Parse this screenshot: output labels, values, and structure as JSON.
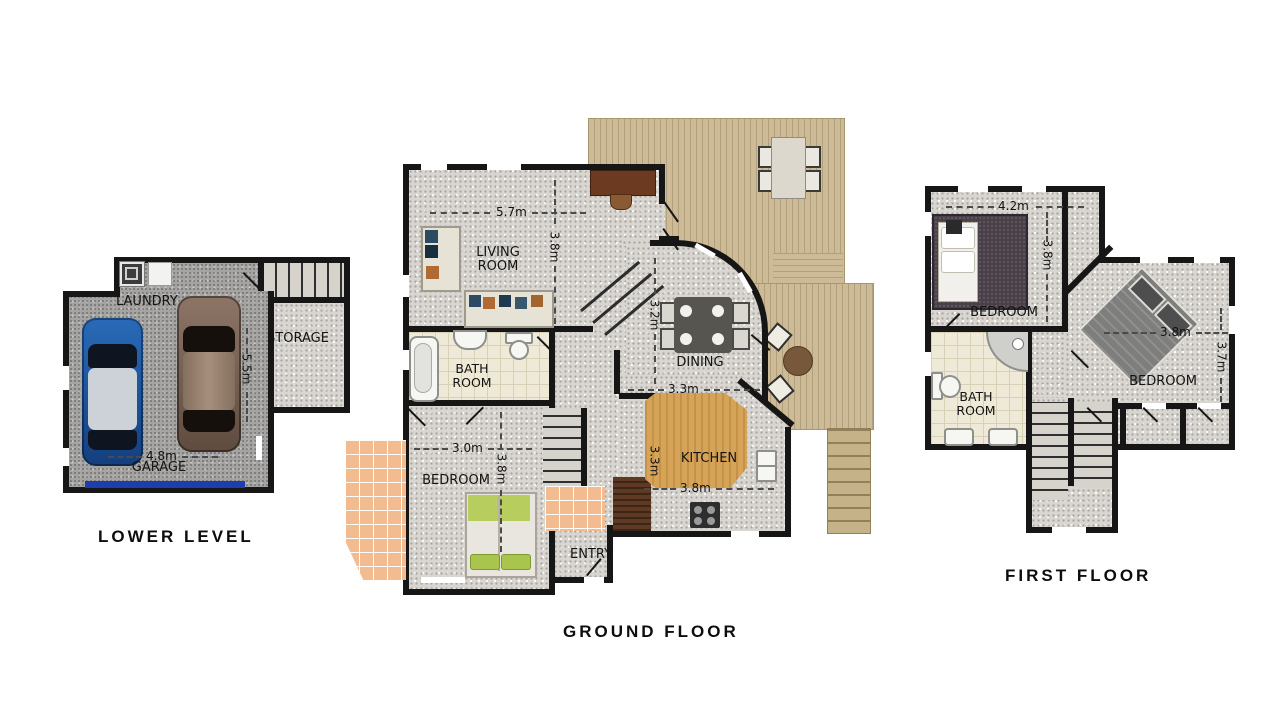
{
  "lower_level": {
    "title": "LOWER LEVEL",
    "labels": {
      "laundry": "LAUNDRY",
      "storage": "STORAGE",
      "garage": "GARAGE"
    },
    "dims": {
      "width": "4.8m",
      "depth": "5.5m"
    }
  },
  "ground_floor": {
    "title": "GROUND FLOOR",
    "labels": {
      "living": "LIVING ROOM",
      "bath": "BATH ROOM",
      "bedroom": "BEDROOM",
      "dining": "DINING",
      "kitchen": "KITCHEN",
      "entry": "ENTRY"
    },
    "dims": {
      "living_width": "5.7m",
      "living_depth": "3.8m",
      "dining_depth": "3.2m",
      "dining_width": "3.3m",
      "kitchen_depth": "3.3m",
      "kitchen_width": "3.8m",
      "bedroom_width": "3.0m",
      "bedroom_depth": "3.8m"
    }
  },
  "first_floor": {
    "title": "FIRST FLOOR",
    "labels": {
      "bedroom1": "BEDROOM",
      "bedroom2": "BEDROOM",
      "bath": "BATH ROOM"
    },
    "dims": {
      "bedroom1_width": "4.2m",
      "bedroom1_depth": "3.8m",
      "bedroom2_width": "3.8m",
      "bedroom2_depth": "3.7m"
    }
  },
  "colors": {
    "wall": "#161616",
    "floor_speckle": "#d9d6d1",
    "garage_floor": "#a5a4a2",
    "deck_wood": "#ccbb96",
    "tile_orange": "#f3bc90",
    "tile_cream": "#efead8",
    "counter_wood": "#d5a458",
    "garage_door": "#1d3fae",
    "car_blue": "#2059a6",
    "car_brown": "#85705f",
    "bed_green": "#b7cd5e"
  }
}
